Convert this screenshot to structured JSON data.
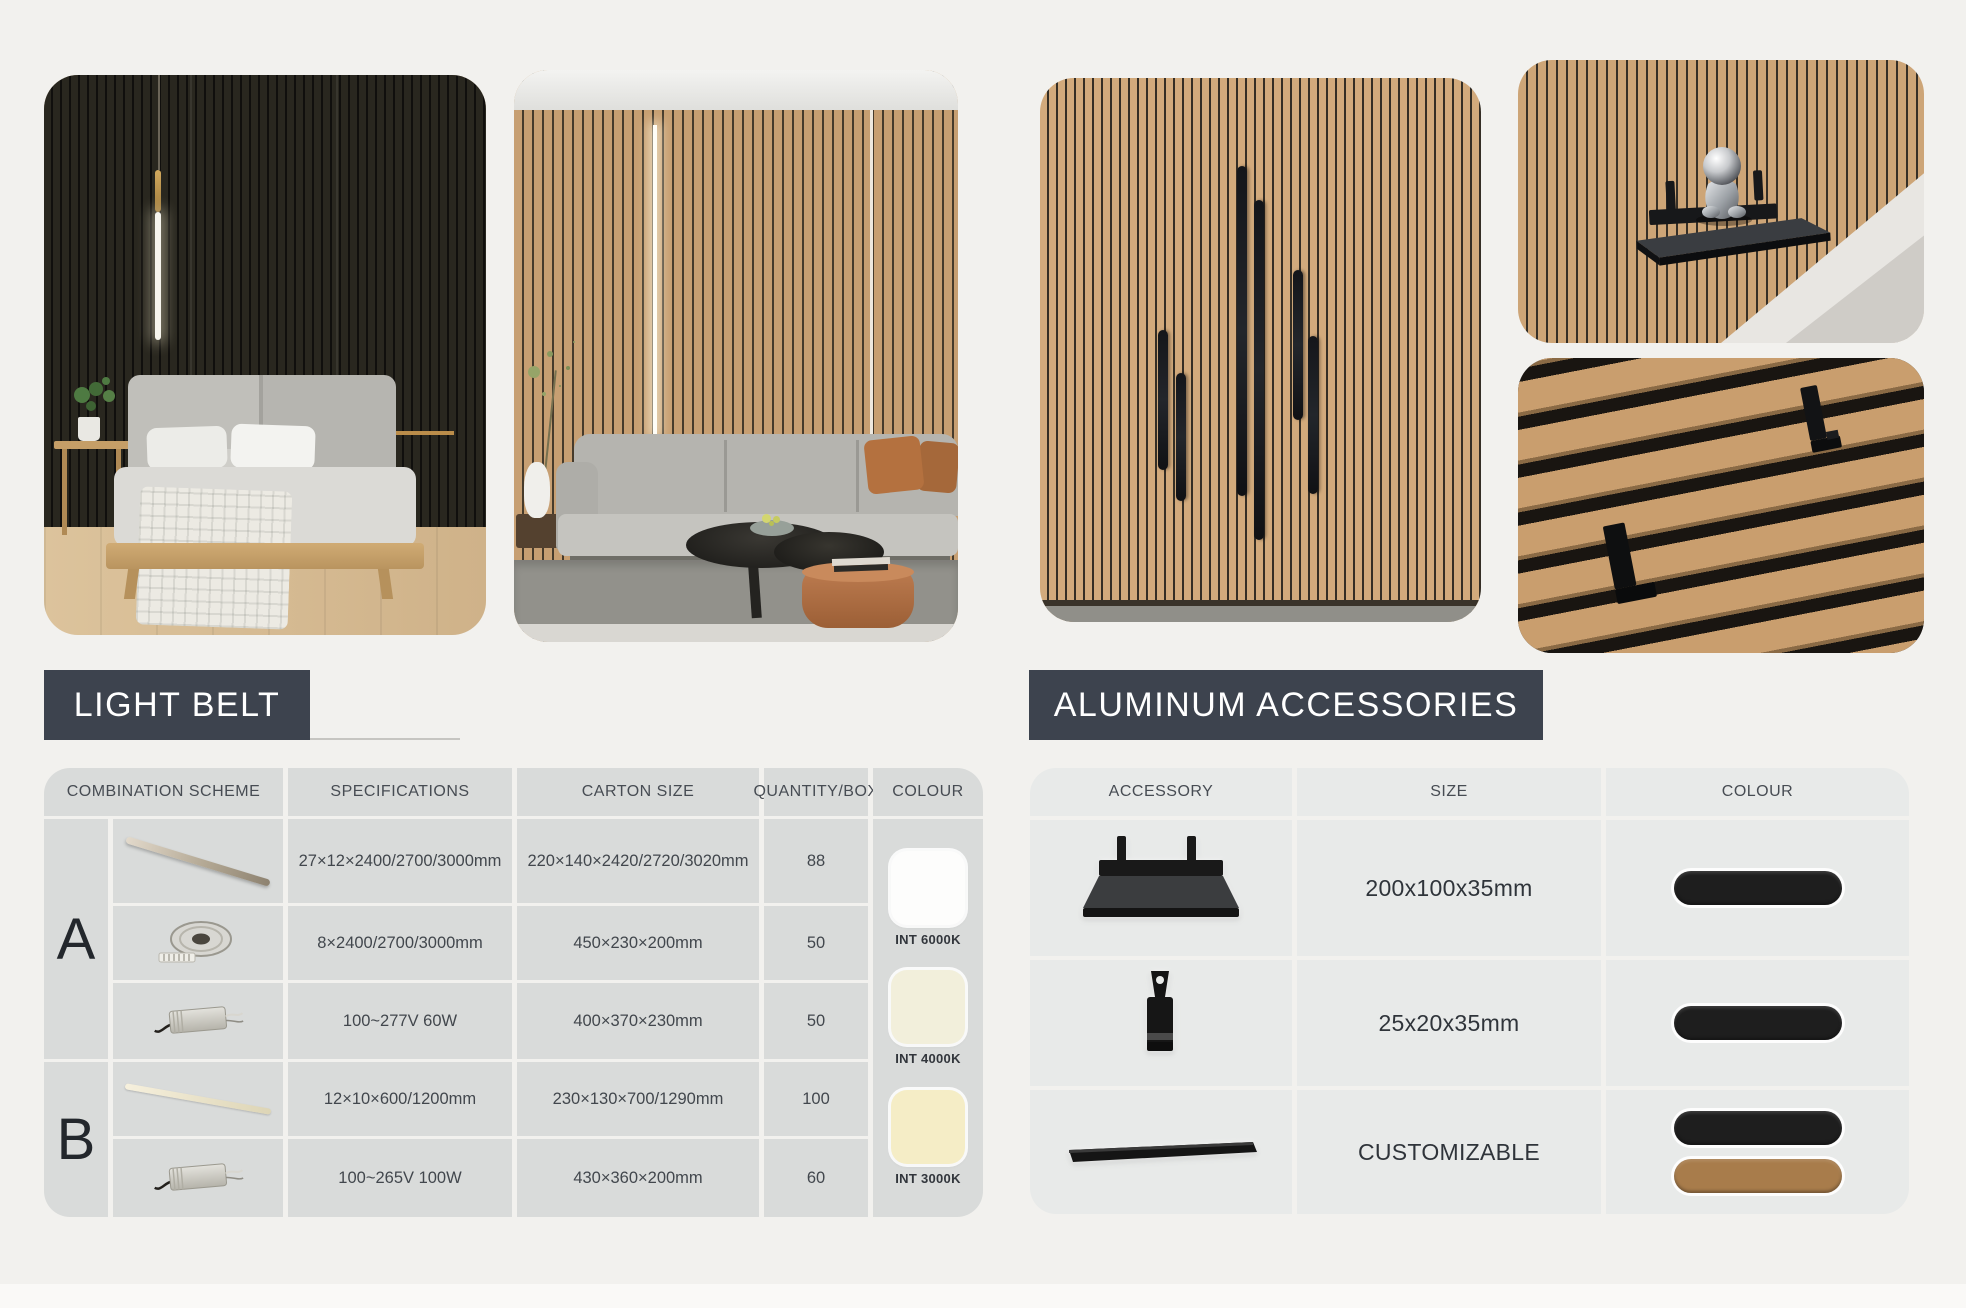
{
  "sections": {
    "light_belt": {
      "title": "LIGHT BELT"
    },
    "aluminum": {
      "title": "ALUMINUM ACCESSORIES"
    }
  },
  "light_belt_table": {
    "headers": {
      "combination_scheme": "COMBINATION SCHEME",
      "specifications": "SPECIFICATIONS",
      "carton_size": "CARTON SIZE",
      "quantity_box": "QUANTITY/BOX",
      "colour": "COLOUR"
    },
    "group_a": {
      "label": "A",
      "rows": [
        {
          "item": "pendant-light-tube",
          "specifications": "27×12×2400/2700/3000mm",
          "carton_size": "220×140×2420/2720/3020mm",
          "quantity": "88"
        },
        {
          "item": "led-strip-reel",
          "specifications": "8×2400/2700/3000mm",
          "carton_size": "450×230×200mm",
          "quantity": "50"
        },
        {
          "item": "led-driver-60w",
          "specifications": "100~277V 60W",
          "carton_size": "400×370×230mm",
          "quantity": "50"
        }
      ]
    },
    "group_b": {
      "label": "B",
      "rows": [
        {
          "item": "mini-light-bar",
          "specifications": "12×10×600/1200mm",
          "carton_size": "230×130×700/1290mm",
          "quantity": "100"
        },
        {
          "item": "led-driver-100w",
          "specifications": "100~265V 100W",
          "carton_size": "430×360×200mm",
          "quantity": "60"
        }
      ]
    },
    "colour_options": [
      {
        "label": "INT 6000K",
        "color": "#fdfdfc"
      },
      {
        "label": "INT 4000K",
        "color": "#f2efdb"
      },
      {
        "label": "INT 3000K",
        "color": "#f5edc6"
      }
    ]
  },
  "accessories_table": {
    "headers": {
      "accessory": "ACCESSORY",
      "size": "SIZE",
      "colour": "COLOUR"
    },
    "rows": [
      {
        "item": "metal-wall-shelf",
        "size": "200x100x35mm",
        "colours": [
          {
            "name": "black",
            "color": "#1e1e1e"
          }
        ]
      },
      {
        "item": "slat-panel-hook",
        "size": "25x20x35mm",
        "colours": [
          {
            "name": "black",
            "color": "#1e1e1e"
          }
        ]
      },
      {
        "item": "aluminum-trim-bar",
        "size": "CUSTOMIZABLE",
        "colours": [
          {
            "name": "black",
            "color": "#1e1e1e"
          },
          {
            "name": "bronze",
            "color": "#a87c4b"
          }
        ]
      }
    ]
  }
}
